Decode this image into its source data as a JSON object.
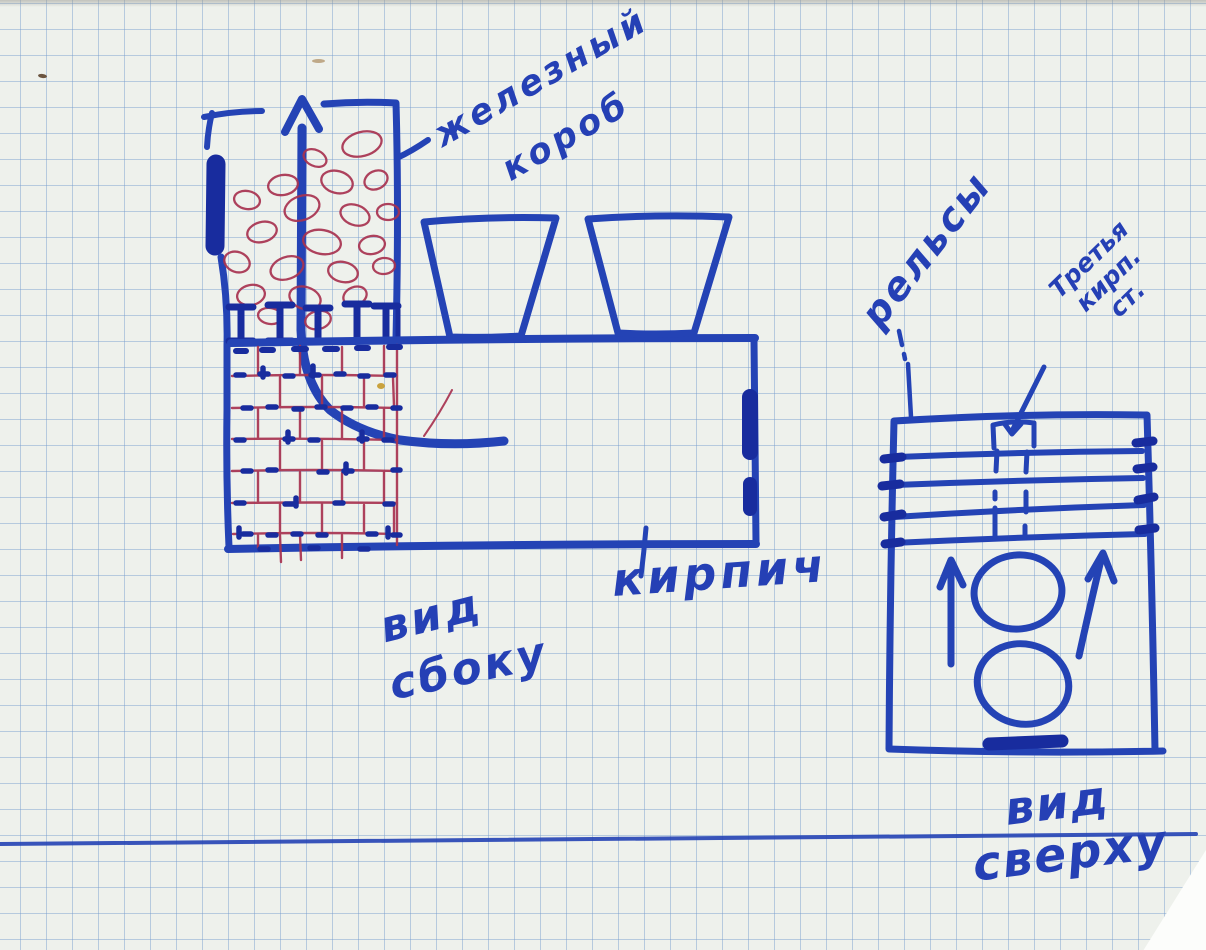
{
  "labels": {
    "iron_box": {
      "line1": "железный",
      "line2": "короб"
    },
    "brick": "кирпич",
    "side_view": {
      "line1": "вид",
      "line2": "сбоку"
    },
    "rails": "рельсы",
    "third_brick_row": {
      "line1": "Третья",
      "line2": "кирп.",
      "line3": "ст."
    },
    "top_view": {
      "line1": "вид",
      "line2": "сверху"
    }
  },
  "colors": {
    "pen_blue": "#2443b5",
    "pen_dark_blue": "#182c9e",
    "pen_red": "#a83350",
    "margin_pink": "#c73a8c",
    "grid_line": "#b5c9e2",
    "paper": "#eef1ec"
  }
}
